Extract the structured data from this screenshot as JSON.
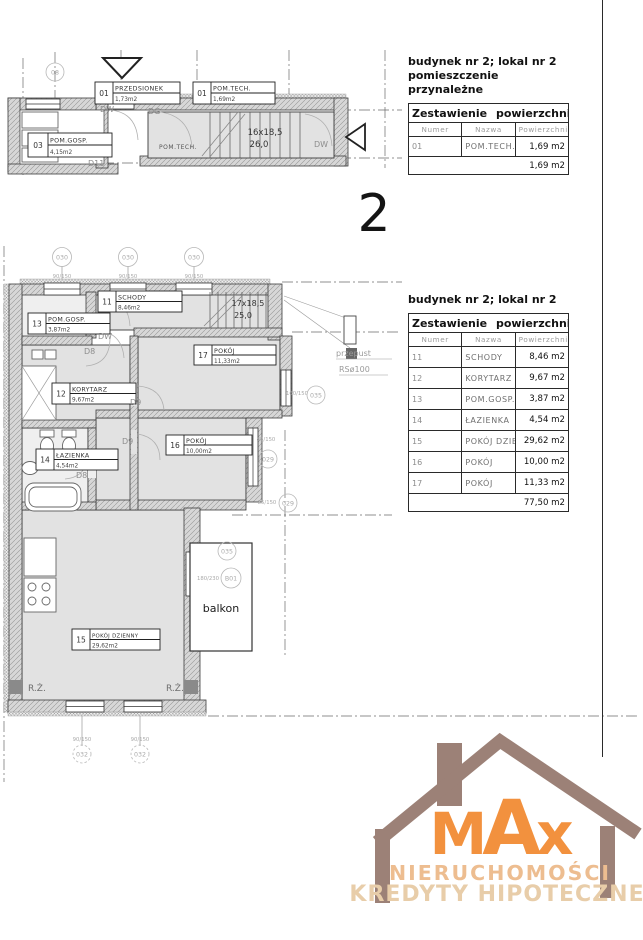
{
  "page": {
    "floor_label": "2"
  },
  "annex": {
    "title_line1": "budynek nr 2; lokal nr 2",
    "title_line2": "pomieszczenie przynależne",
    "table_title": "Zestawienie powierzchni",
    "col_numer": "Numer",
    "col_nazwa": "Nazwa",
    "col_pow": "Powierzchnia",
    "rows": [
      {
        "numer": "01",
        "nazwa": "POM.TECH.",
        "pow": "1,69 m2"
      }
    ],
    "total": "1,69 m2"
  },
  "apartment": {
    "title": "budynek nr 2; lokal nr 2",
    "table_title": "Zestawienie powierzchni",
    "col_numer": "Numer",
    "col_nazwa": "Nazwa",
    "col_pow": "Powierzchnia",
    "rows": [
      {
        "numer": "11",
        "nazwa": "SCHODY",
        "pow": "8,46 m2"
      },
      {
        "numer": "12",
        "nazwa": "KORYTARZ",
        "pow": "9,67 m2"
      },
      {
        "numer": "13",
        "nazwa": "POM.GOSP.",
        "pow": "3,87 m2"
      },
      {
        "numer": "14",
        "nazwa": "ŁAZIENKA",
        "pow": "4,54 m2"
      },
      {
        "numer": "15",
        "nazwa": "POKÓJ DZIENNY",
        "pow": "29,62 m2"
      },
      {
        "numer": "16",
        "nazwa": "POKÓJ",
        "pow": "10,00 m2"
      },
      {
        "numer": "17",
        "nazwa": "POKÓJ",
        "pow": "11,33 m2"
      }
    ],
    "total": "77,50 m2"
  },
  "upper_plan": {
    "axis_08": "08",
    "przedsionek": {
      "num": "01",
      "name": "PRZEDSIONEK",
      "area": "1,73m2"
    },
    "pomtech": {
      "num": "01",
      "name": "POM.TECH.",
      "area": "1,69m2"
    },
    "pomgosp": {
      "num": "03",
      "name": "POM.GOSP.",
      "area": "4,15m2"
    },
    "room_pomtech": "POM.TECH.",
    "stairs_1": "16x18,5",
    "stairs_2": "26,0",
    "door_dw": "DW",
    "door_dg": "DG",
    "door_d11": "D11"
  },
  "main_plan": {
    "axis_top": "030",
    "dim_win_top": "90/150",
    "rooms": {
      "schody": {
        "num": "11",
        "name": "SCHODY",
        "area": "8,46m2"
      },
      "korytarz": {
        "num": "12",
        "name": "KORYTARZ",
        "area": "9,67m2"
      },
      "pomgosp": {
        "num": "13",
        "name": "POM.GOSP.",
        "area": "3,87m2"
      },
      "lazienka": {
        "num": "14",
        "name": "ŁAZIENKA",
        "area": "4,54m2"
      },
      "dzienny": {
        "num": "15",
        "name": "POKÓJ DZIENNY",
        "area": "29,62m2"
      },
      "pokoj16": {
        "num": "16",
        "name": "POKÓJ",
        "area": "10,00m2"
      },
      "pokoj17": {
        "num": "17",
        "name": "POKÓJ",
        "area": "11,33m2"
      }
    },
    "stairs_1": "17x18,5",
    "stairs_2": "25,0",
    "door_dw": "DW",
    "door_d8": "D8",
    "door_d9": "D9",
    "przepust": "przepust",
    "pipe": "RSø100",
    "balkon": "balkon",
    "rz": "R.Ż.",
    "m035": "035",
    "m029": "029",
    "m032": "032",
    "mb01": "B01",
    "dim_160_150": "160/150",
    "dim_85_150": "85/150",
    "dim_180_230": "180/230"
  },
  "logo": {
    "brand": "MAx",
    "line1": "NIERUCHOMOŚCI",
    "line2": "KREDYTY HIPOTECZNE",
    "house_color": "#9c8177",
    "brand_color": "#f2913e",
    "subtext_color": "#e8cda9"
  }
}
